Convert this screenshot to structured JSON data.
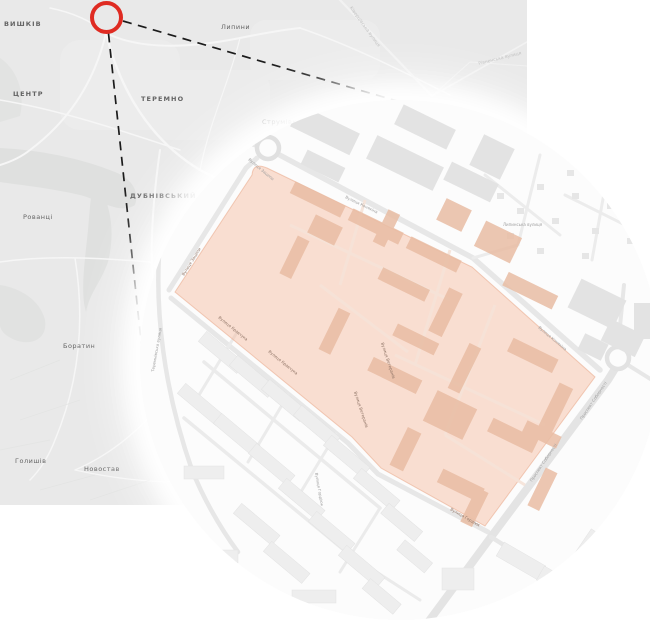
{
  "overview": {
    "place_labels": [
      {
        "text": "ВИШКІВ"
      },
      {
        "text": "ЦЕНТР"
      },
      {
        "text": "ТЕРЕМНО"
      },
      {
        "text": "Липини"
      },
      {
        "text": "ДУБНІВСЬКИЙ"
      },
      {
        "text": "Рованці"
      },
      {
        "text": "Боратин"
      },
      {
        "text": "Голишів"
      },
      {
        "text": "Новостав"
      },
      {
        "text": "Струмівка"
      }
    ],
    "road_labels": [
      {
        "text": "Ківерцівська вулиця"
      },
      {
        "text": "Рівненська вулиця"
      }
    ]
  },
  "callout": {
    "marker_color": "#df2b22",
    "line_color": "#1b1b1b"
  },
  "inset": {
    "highlight_color": "#f5b695",
    "street_labels": [
      {
        "text": "Вулиця Конякіна"
      },
      {
        "text": "Вулиця Конякіна"
      },
      {
        "text": "Проспект Соборності"
      },
      {
        "text": "Проспект Соборності"
      },
      {
        "text": "Вулиця Гордіюк"
      },
      {
        "text": "Вулиця Зацепи"
      },
      {
        "text": "Вулиця Кравчука"
      },
      {
        "text": "Вулиця Кравчука"
      },
      {
        "text": "Вулиця Ветеранів"
      },
      {
        "text": "Вулиця Ветеранів"
      },
      {
        "text": "Вулиця Гордіюк"
      },
      {
        "text": "Липинська вулиця"
      },
      {
        "text": "Теремнівська вулиця"
      },
      {
        "text": "Вулиця Зацепи"
      }
    ]
  },
  "colors": {
    "overview_bg": "#e9e9e9",
    "inset_bg": "#fcfcfc",
    "terrain_patch": "#dfe0df",
    "building_grey": "#e5e5e5",
    "building_highlighted": "#e9bda4"
  }
}
